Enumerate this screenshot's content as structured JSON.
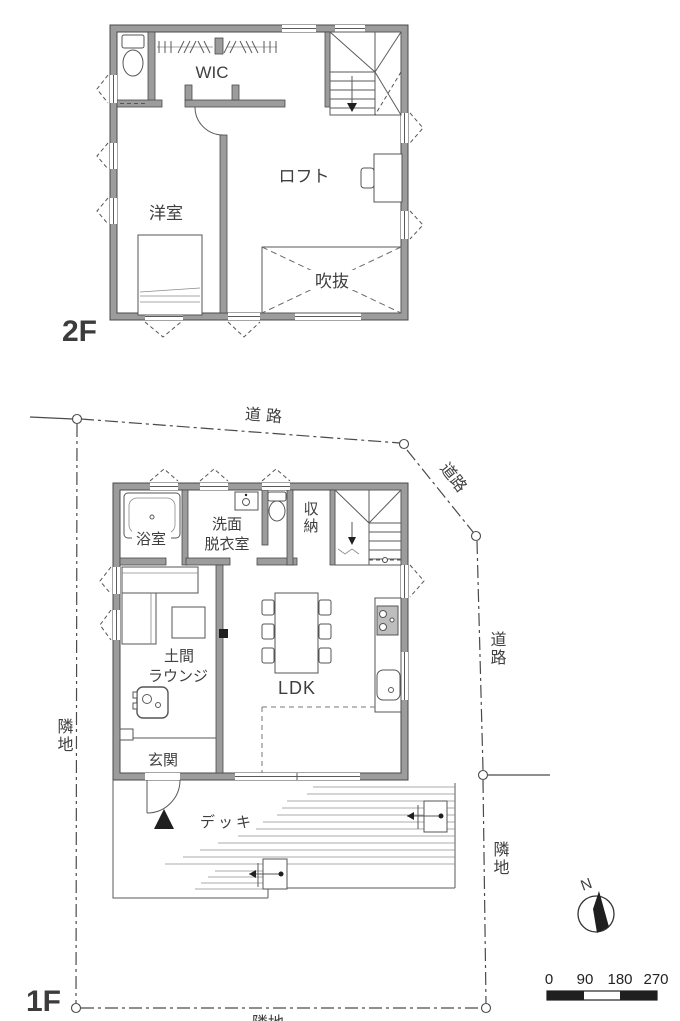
{
  "floor2": {
    "label": "2F",
    "rooms": {
      "wic": "WIC",
      "loft": "ロフト",
      "bedroom": "洋室",
      "void": "吹抜"
    }
  },
  "floor1": {
    "label": "1F",
    "rooms": {
      "bath": "浴室",
      "washroom_line1": "洗面",
      "washroom_line2": "脱衣室",
      "storage": "収納",
      "doma_lounge_line1": "土間",
      "doma_lounge_line2": "ラウンジ",
      "ldk": "LDK",
      "entrance": "玄関",
      "deck": "デッキ"
    }
  },
  "site": {
    "road_top": "道路",
    "road_corner": "道路",
    "road_right": "道路",
    "neighbor_left": "隣地",
    "neighbor_right": "隣地",
    "neighbor_bottom": "隣地"
  },
  "compass": {
    "north_label": "N"
  },
  "scale_bar": {
    "ticks": [
      "0",
      "90",
      "180",
      "270"
    ]
  },
  "colors": {
    "wall_fill": "#9c9c9c",
    "wall_outline": "#4a4a4a",
    "line": "#4a4a4a",
    "text": "#3f3f3f",
    "marker_fill": "#1f1f1f",
    "background": "#ffffff"
  }
}
